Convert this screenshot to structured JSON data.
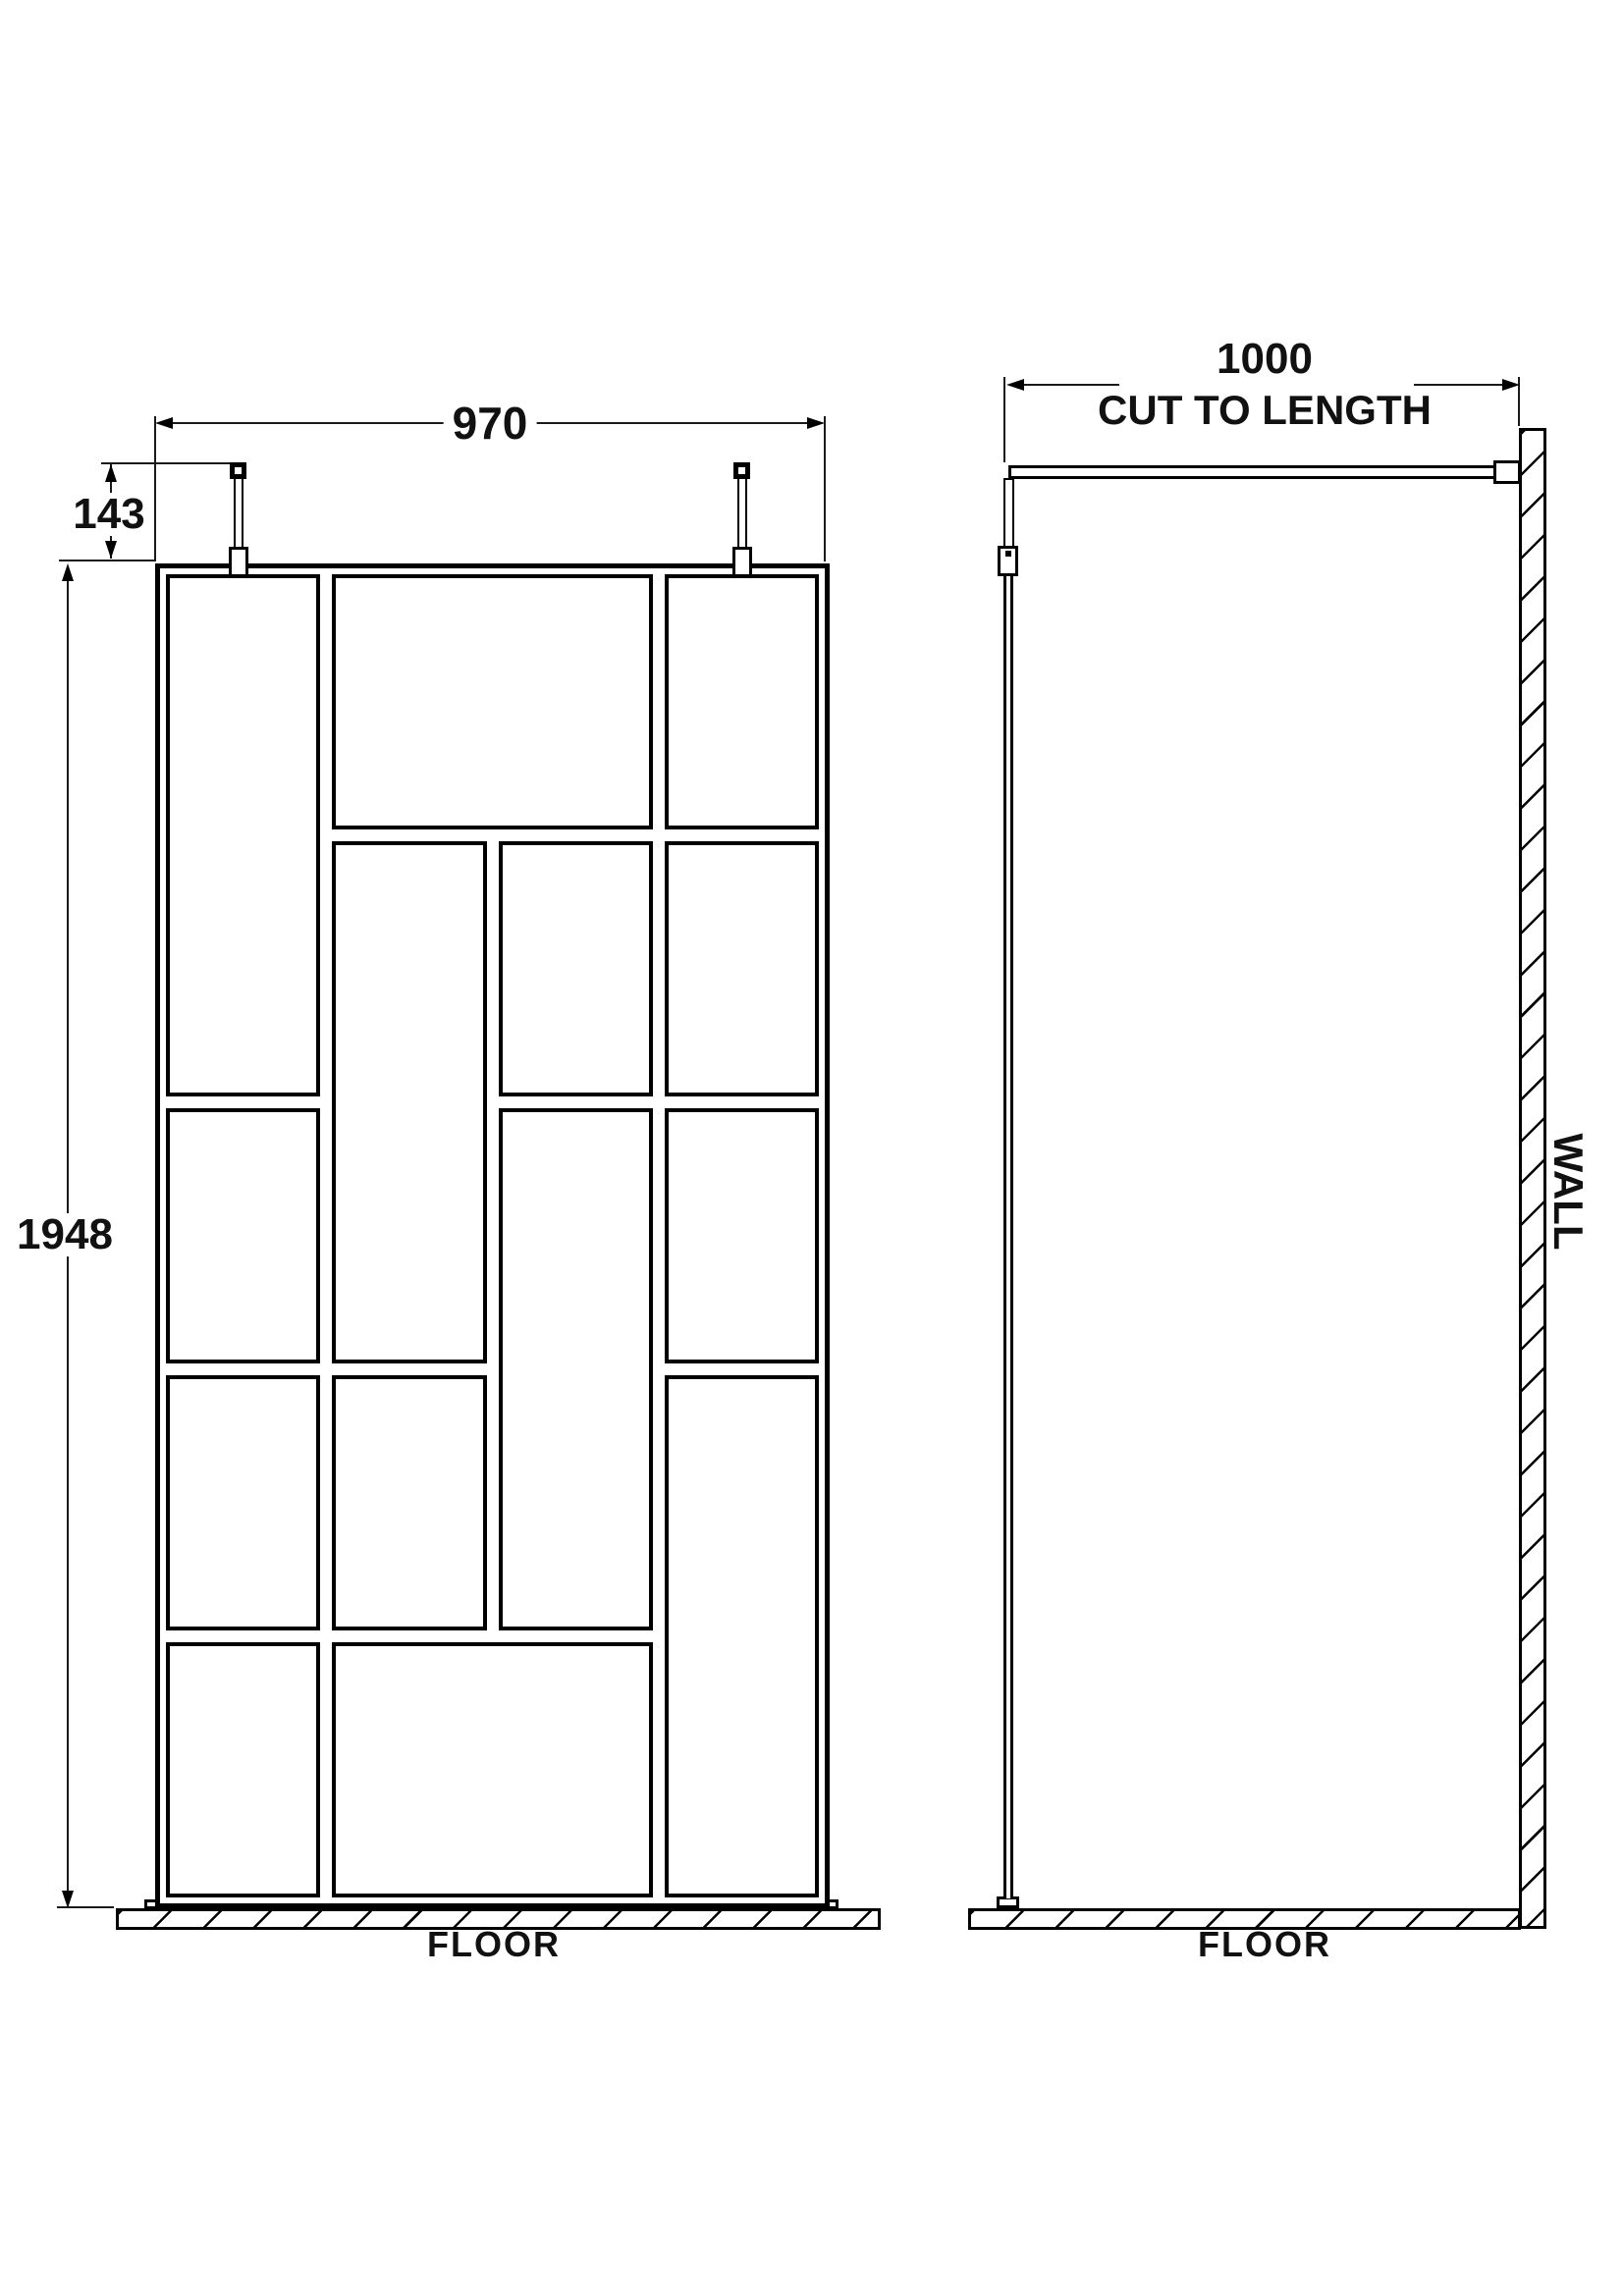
{
  "labels": {
    "front_width_dim": "970",
    "post_drop_dim": "143",
    "screen_height_dim": "1948",
    "support_bar_dim": "1000",
    "support_bar_note": "CUT TO LENGTH",
    "wall": "WALL",
    "floor_front": "FLOOR",
    "floor_side": "FLOOR"
  },
  "front_view": {
    "description": "Front elevation of framed walk-in shower screen with abstract crittall pane pattern",
    "grid": {
      "columns": 4,
      "rows": 5
    },
    "panes": [
      {
        "row": 1,
        "col": 1,
        "row_span": 2,
        "col_span": 1
      },
      {
        "row": 1,
        "col": 2,
        "row_span": 1,
        "col_span": 2
      },
      {
        "row": 1,
        "col": 4,
        "row_span": 1,
        "col_span": 1
      },
      {
        "row": 2,
        "col": 2,
        "row_span": 2,
        "col_span": 1
      },
      {
        "row": 2,
        "col": 3,
        "row_span": 1,
        "col_span": 1
      },
      {
        "row": 2,
        "col": 4,
        "row_span": 1,
        "col_span": 1
      },
      {
        "row": 3,
        "col": 1,
        "row_span": 1,
        "col_span": 1
      },
      {
        "row": 3,
        "col": 3,
        "row_span": 2,
        "col_span": 1
      },
      {
        "row": 3,
        "col": 4,
        "row_span": 1,
        "col_span": 1
      },
      {
        "row": 4,
        "col": 1,
        "row_span": 1,
        "col_span": 1
      },
      {
        "row": 4,
        "col": 2,
        "row_span": 1,
        "col_span": 1
      },
      {
        "row": 4,
        "col": 4,
        "row_span": 2,
        "col_span": 1
      },
      {
        "row": 5,
        "col": 1,
        "row_span": 1,
        "col_span": 1
      },
      {
        "row": 5,
        "col": 2,
        "row_span": 1,
        "col_span": 2
      }
    ],
    "support_posts": 2
  },
  "side_view": {
    "description": "Side elevation showing glass edge, ceiling post, wall-mounted support arm, wall and floor",
    "support_bar": "cut to length"
  },
  "colors": {
    "line": "#000000",
    "background": "#ffffff"
  }
}
